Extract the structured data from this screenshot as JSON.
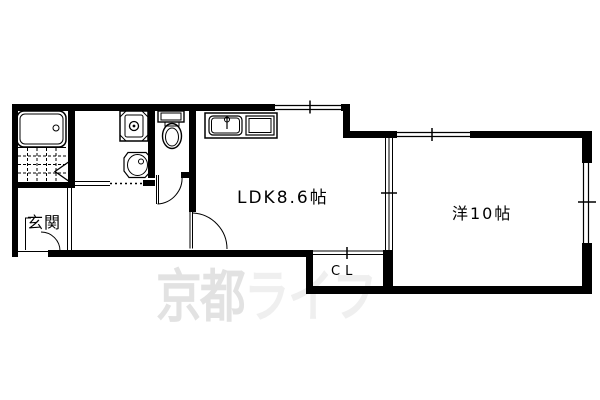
{
  "floorplan": {
    "labels": {
      "genkan": "玄関",
      "ldk": "LDK8.6帖",
      "western_room": "洋10帖",
      "closet": "CL"
    },
    "watermark": {
      "part1": "京都",
      "part2": "ライフ",
      "part1_color": "#e2e2e2",
      "part2_color": "#efefef"
    },
    "colors": {
      "wall": "#000000",
      "background": "#ffffff"
    },
    "fixture_icons": [
      "bathtub-icon",
      "tile-floor-icon",
      "folding-door-icon",
      "washing-machine-pan-icon",
      "wash-basin-icon",
      "toilet-icon",
      "kitchen-sink-icon",
      "stove-icon",
      "door-swing-icon",
      "sliding-window-icon"
    ]
  }
}
